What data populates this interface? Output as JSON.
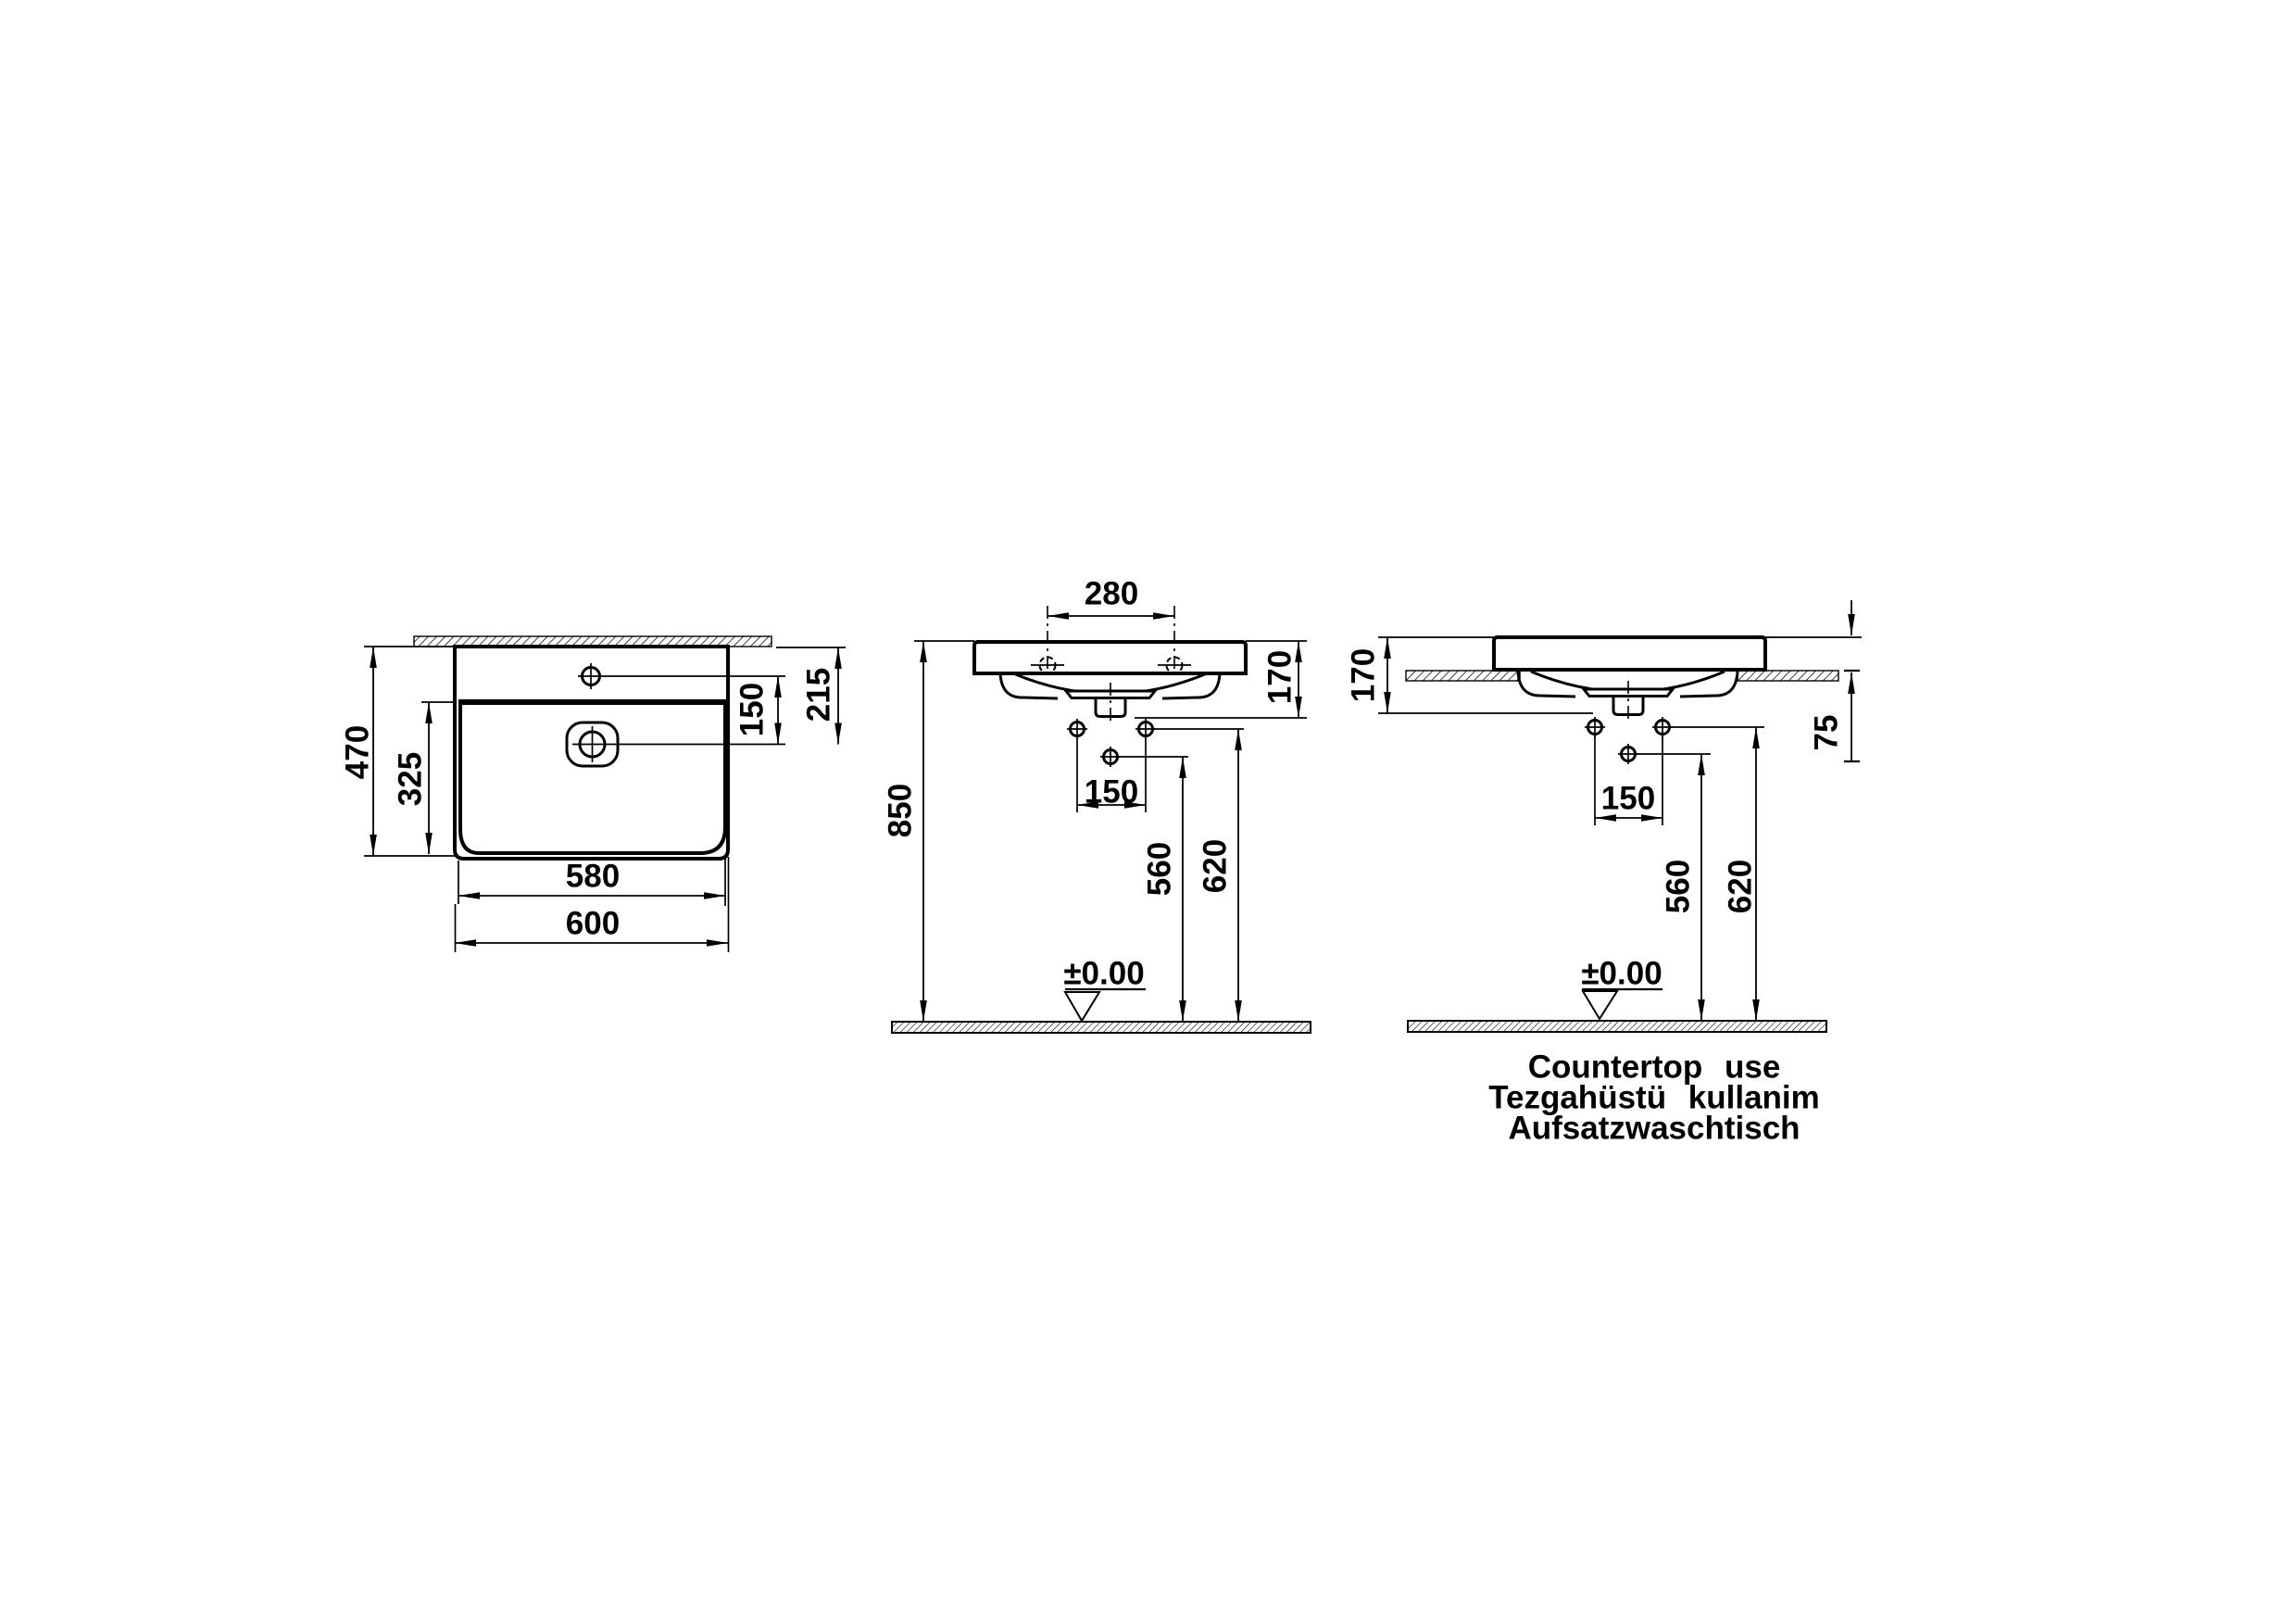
{
  "background": "#ffffff",
  "line_color": "#000000",
  "views": {
    "plan": {
      "name": "plan-view",
      "dims": {
        "overall_depth": "470",
        "bowl_depth": "325",
        "tap_to_drain": "150",
        "wall_to_drain": "215",
        "bowl_width": "580",
        "overall_width": "600"
      }
    },
    "wall": {
      "name": "wall-mounted-view",
      "dims": {
        "tap_centers": "280",
        "basin_height": "170",
        "rim_from_floor": "850",
        "supply_spacing": "150",
        "drain_from_floor": "560",
        "supply_from_floor": "620"
      },
      "datum": "±0.00"
    },
    "counter": {
      "name": "countertop-view",
      "dims": {
        "basin_height": "170",
        "rim_above_counter": "75",
        "supply_spacing": "150",
        "drain_from_floor": "560",
        "supply_from_floor": "620"
      },
      "datum": "±0.00",
      "caption_line1": "Countertop use",
      "caption_line2": "Tezgahüstü kullanim",
      "caption_line3": "Aufsatzwaschtisch"
    }
  }
}
